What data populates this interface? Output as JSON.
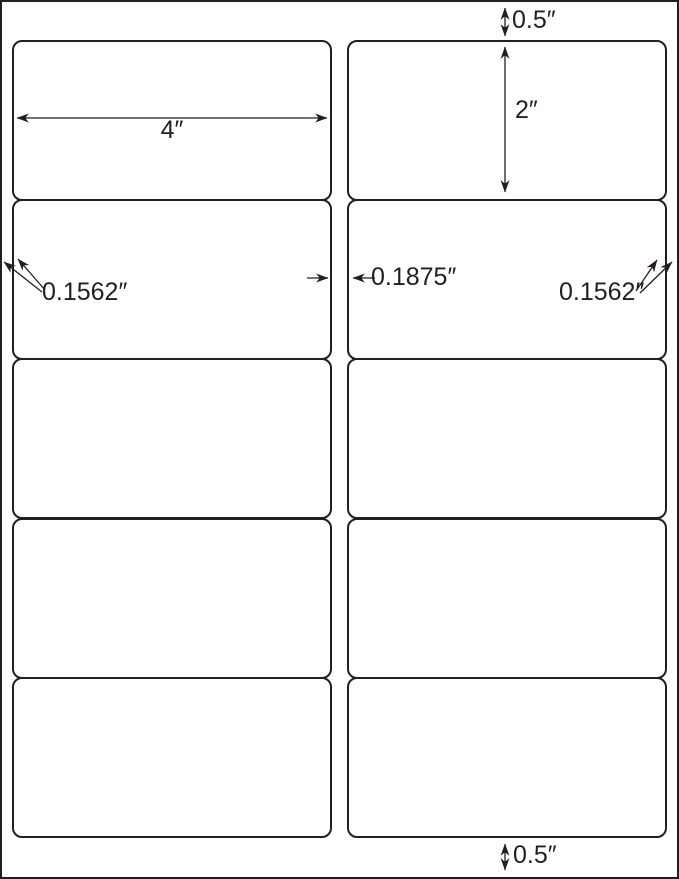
{
  "diagram": {
    "kind": "label-sheet-template",
    "colors": {
      "ink": "#231f20",
      "paper": "#ffffff"
    },
    "grid": {
      "columns": 2,
      "rows": 5,
      "label_count": 10
    },
    "dimensions": {
      "top_margin": "0.5″",
      "bottom_margin": "0.5″",
      "label_width": "4″",
      "label_height": "2″",
      "left_margin": "0.1562″",
      "right_margin": "0.1562″",
      "column_gap": "0.1875″"
    }
  }
}
